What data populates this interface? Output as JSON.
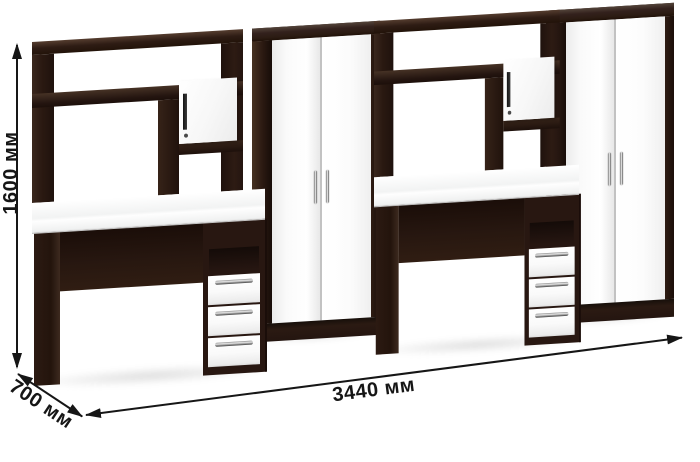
{
  "scene": {
    "type": "furniture-product-render",
    "dimensions": {
      "height_label": "1600 мм",
      "depth_label": "700 мм",
      "width_label": "3440 мм"
    },
    "colors": {
      "background": "#ffffff",
      "body_dark_wenge": "#2b1a13",
      "front_white": "#fbfbfb",
      "handle_chrome": "#c8c8c8",
      "annotation": "#161616"
    },
    "furniture": {
      "desk_units": 2,
      "wardrobes": 2,
      "drawers_per_desk": 3,
      "doors_per_wardrobe": 2,
      "hutch_doors_per_desk": 1
    }
  }
}
